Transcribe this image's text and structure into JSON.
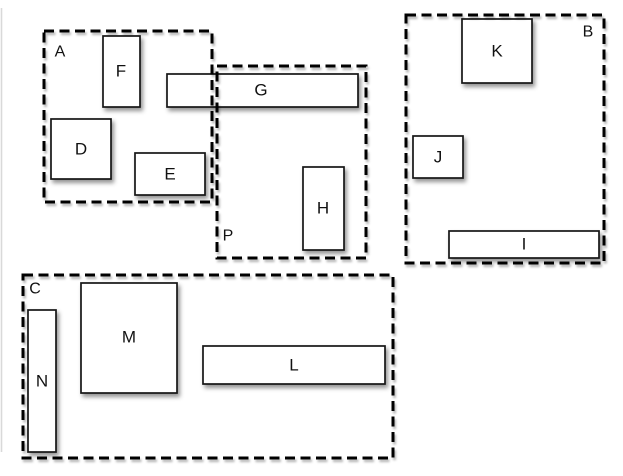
{
  "diagram": {
    "description": "Layout diagram of dashed group containers with solid labeled boxes",
    "colors": {
      "background": "#ffffff",
      "shape_fill": "#ffffff",
      "shape_stroke": "#161616",
      "dash_stroke": "#000000",
      "page_edge_line": "#d9d9d9"
    },
    "containers": [
      {
        "id": "A",
        "label": "A",
        "label_position": "top-left"
      },
      {
        "id": "B",
        "label": "B",
        "label_position": "top-right"
      },
      {
        "id": "C",
        "label": "C",
        "label_position": "top-left"
      },
      {
        "id": "P",
        "label": "P",
        "label_position": "bottom-left"
      }
    ],
    "boxes": [
      {
        "id": "F",
        "label": "F",
        "container": "A"
      },
      {
        "id": "D",
        "label": "D",
        "container": "A"
      },
      {
        "id": "E",
        "label": "E",
        "container": "A"
      },
      {
        "id": "G",
        "label": "G",
        "container": "A,P"
      },
      {
        "id": "H",
        "label": "H",
        "container": "P"
      },
      {
        "id": "K",
        "label": "K",
        "container": "B"
      },
      {
        "id": "J",
        "label": "J",
        "container": "B"
      },
      {
        "id": "I",
        "label": "I",
        "container": "B"
      },
      {
        "id": "M",
        "label": "M",
        "container": "C"
      },
      {
        "id": "N",
        "label": "N",
        "container": "C"
      },
      {
        "id": "L",
        "label": "L",
        "container": "C"
      }
    ]
  }
}
